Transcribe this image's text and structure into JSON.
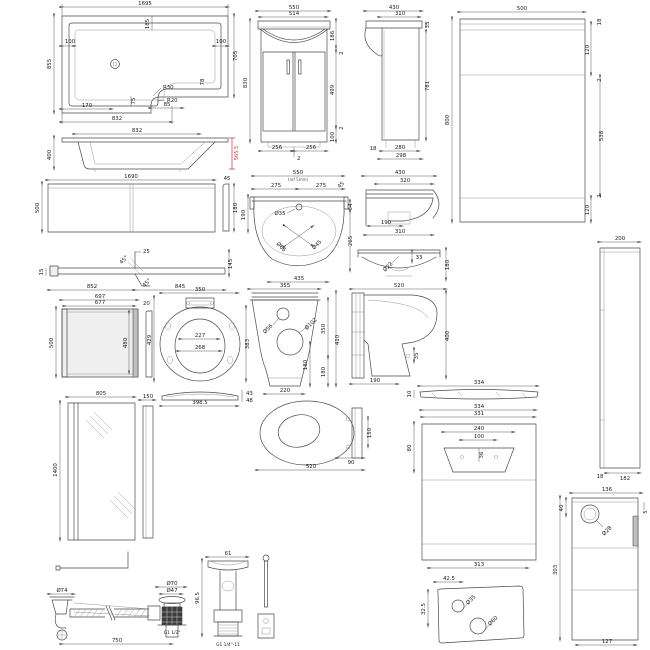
{
  "meta": {
    "background_color": "#ffffff",
    "line_color": "#4a4a4a",
    "highlight_color": "#e03030",
    "sheet_type": "bathroom-suite-technical-dimension-drawings"
  },
  "dims": {
    "bath_plan": {
      "w": "1695",
      "ti": "185",
      "d": "855",
      "li": "100",
      "ri": "100",
      "h": "705",
      "s": "78",
      "r1": "R30",
      "r2": "R20",
      "b1": "170",
      "b2": "75",
      "b3": "85",
      "bw": "832"
    },
    "bath_elev": {
      "w": "832",
      "h": "400",
      "red": "565.5"
    },
    "front_panel": {
      "w": "1690",
      "h": "500",
      "st": "45",
      "sh": "180"
    },
    "cross_sec": {
      "t": "25",
      "a1": "45°",
      "a2": "45°",
      "l": "15",
      "r": "145",
      "b1": "852",
      "b2": "845"
    },
    "end_panel": {
      "w1": "697",
      "w2": "677",
      "t": "20",
      "h": "500",
      "h2": "480"
    },
    "screen": {
      "w": "805",
      "h": "1400",
      "s": "150"
    },
    "van_f": {
      "w": "550",
      "w2": "514",
      "h": "830",
      "r1": "186",
      "r2": "2",
      "r3": "499",
      "r4": "2",
      "r5": "100",
      "b1": "256",
      "b2": "256",
      "b3": "2"
    },
    "van_s": {
      "w": "430",
      "w2": "310",
      "t": "35",
      "h": "781",
      "b1": "18",
      "b2": "280",
      "b3": "298"
    },
    "wc_f": {
      "w": "500",
      "h": "800",
      "t": "18",
      "r1": "120",
      "r2": "2",
      "r3": "538",
      "r4": "120",
      "r5": "2"
    },
    "wc_s": {
      "w": "200",
      "b1": "18",
      "b2": "182"
    },
    "basin_p": {
      "w": "550",
      "sub": "(ref 5mm)",
      "c": "45",
      "l1": "275",
      "l2": "275",
      "tap": "Ø35",
      "d1": "Ø66",
      "d2": "Ø45",
      "lv": "190",
      "r1": "34",
      "r2": "265",
      "b": "435"
    },
    "basin_s": {
      "w": "430",
      "w2": "320",
      "i": "190",
      "b": "310"
    },
    "basin_f": {
      "d": "Ø22",
      "t": "33",
      "r": "180"
    },
    "wc_b": {
      "w": "355",
      "d1": "Ø56",
      "d2": "Ø102",
      "i": "180",
      "b": "220",
      "c1": "350",
      "c2": "180",
      "c3": "410"
    },
    "wc_sv": {
      "w": "520",
      "h": "400",
      "s": "35",
      "b": "190"
    },
    "seat": {
      "w": "350",
      "l": "429",
      "r": "383",
      "i1": "227",
      "i2": "268",
      "pw": "398.5",
      "p1": "43",
      "p2": "48"
    },
    "seat2": {
      "r": "150",
      "b": "90",
      "w": "520"
    },
    "lid": {
      "t": "10",
      "w": "334"
    },
    "cis_f": {
      "w1": "334",
      "w2": "331",
      "w3": "240",
      "w4": "100",
      "c": "36",
      "l": "80",
      "b": "313"
    },
    "tank": {
      "t": "42.5",
      "l": "32.5",
      "d1": "Ø35",
      "d2": "Ø60"
    },
    "cis_s": {
      "w": "136",
      "l": "40",
      "r": "5",
      "d": "Ø28",
      "h": "303",
      "b": "127"
    },
    "waste": {
      "d1": "Ø74",
      "d2": "Ø70",
      "d3": "Ø47",
      "len": "750",
      "th": "G1 1/2\""
    },
    "plug": {
      "w": "61",
      "h": "96.5",
      "th": "G1 1/4\"-11"
    }
  }
}
